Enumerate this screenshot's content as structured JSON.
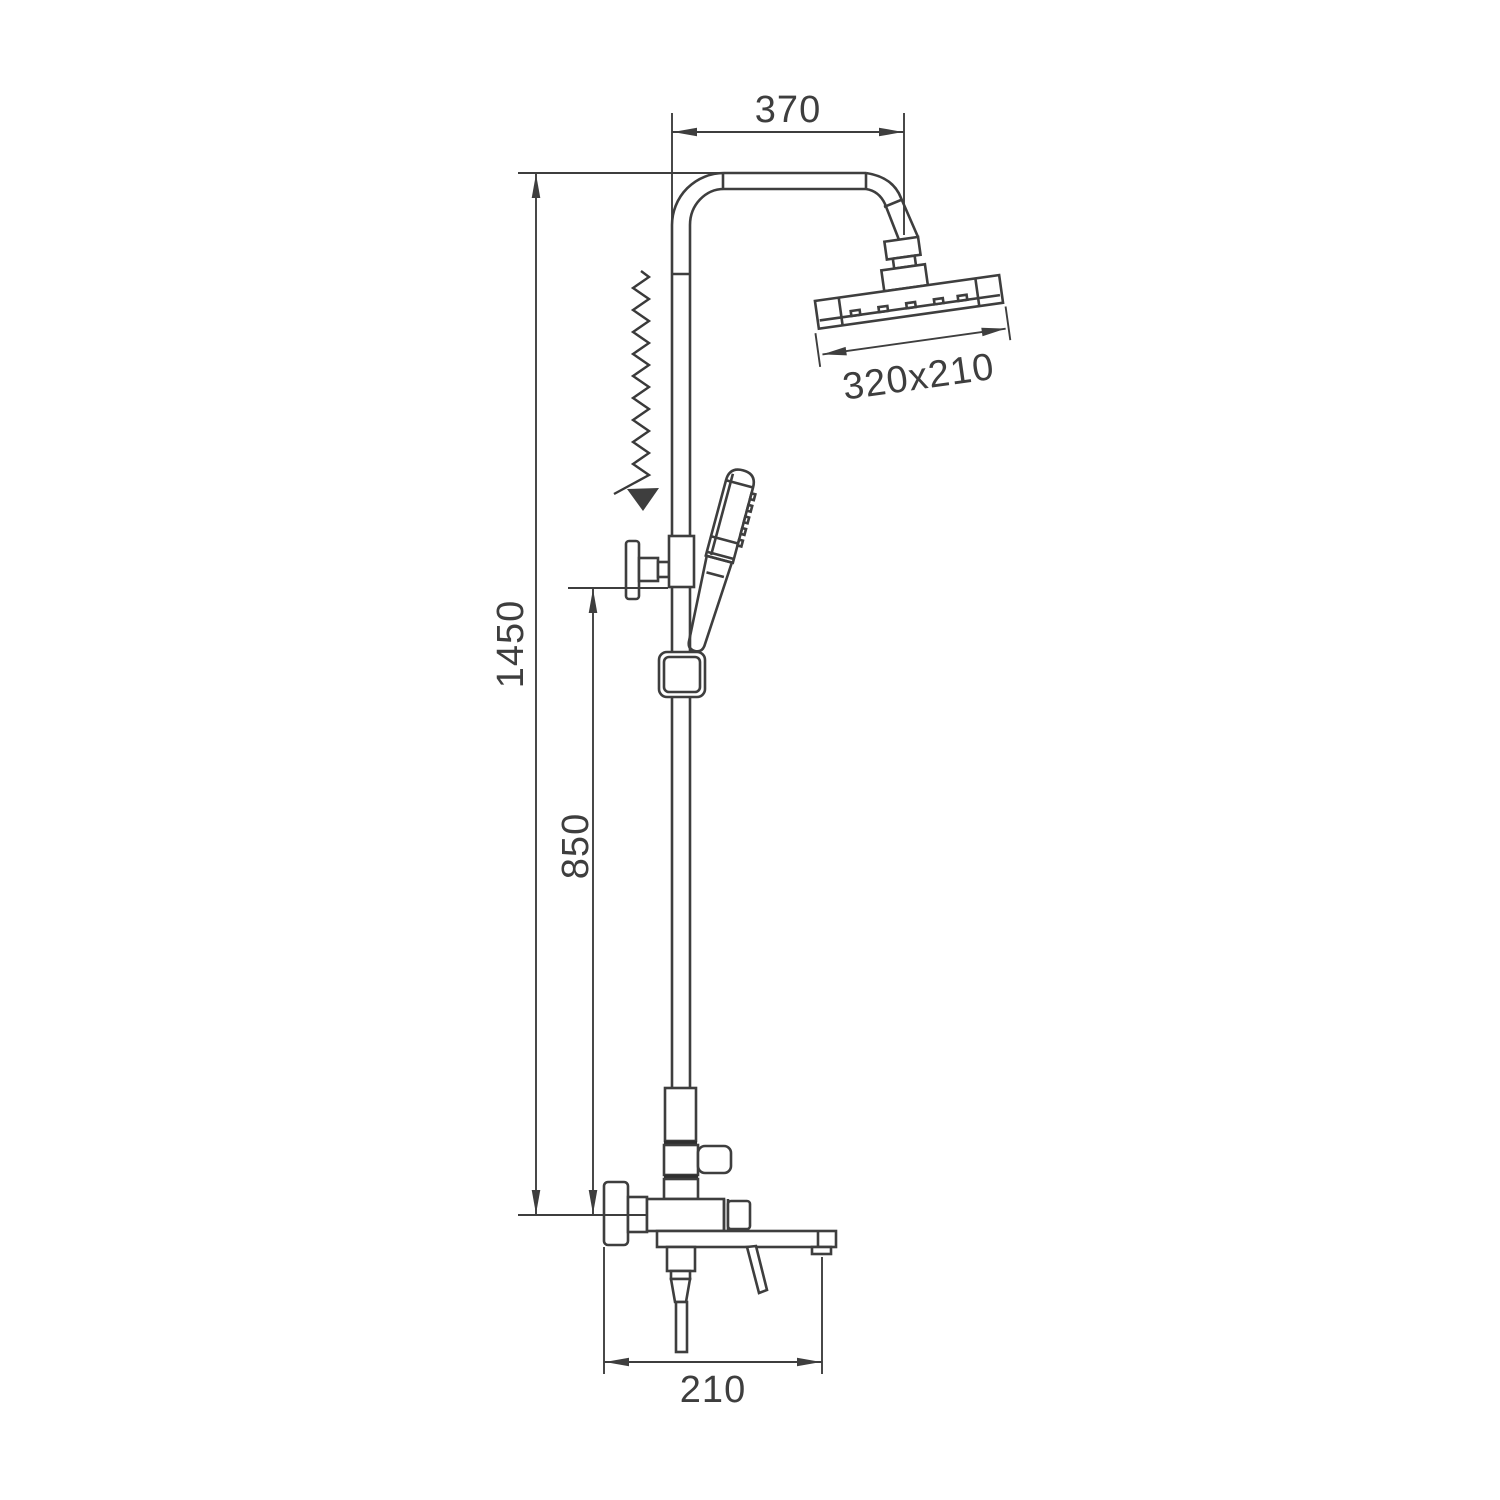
{
  "diagram": {
    "type": "technical-drawing",
    "subject": "exposed shower column with rain head, hand shower and tub spout — dimensioned side elevation",
    "background": "#ffffff",
    "line_color": "#3e3e3e",
    "dimensions": {
      "arm_reach": "370",
      "rain_head_size": "320x210",
      "total_height": "1450",
      "mixer_height": "850",
      "spout_reach": "210"
    },
    "annotations": {
      "slide_arrow": "zigzag-down-arrow (height adjustable slider)"
    },
    "parts": [
      "shower-arm",
      "rain-shower-head",
      "riser-pipe",
      "wall-bracket",
      "slider-block",
      "hand-shower",
      "hand-shower-holder",
      "diverter-body",
      "diverter-knob",
      "wall-plate",
      "mixer-valve",
      "tub-spout",
      "lever-handle",
      "outlet-connector"
    ]
  }
}
